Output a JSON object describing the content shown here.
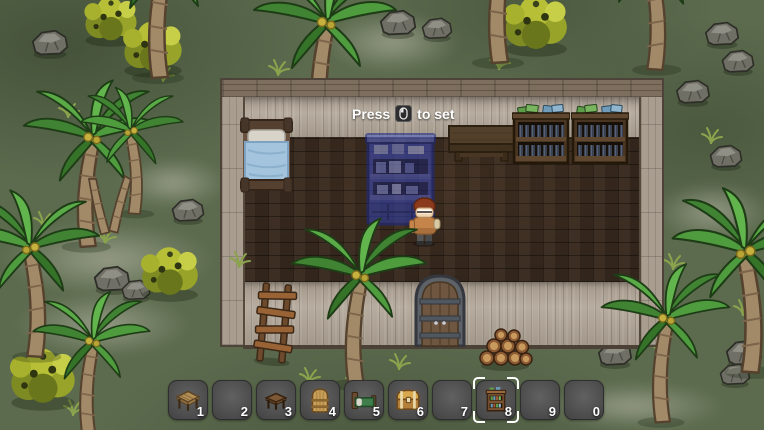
{
  "hint": {
    "prefix": "Press",
    "suffix": "to set",
    "icon": "mouse-left-button-icon"
  },
  "hotbar": {
    "selected_slot_key": "8",
    "slots": [
      {
        "key": "1",
        "item": "wooden-table"
      },
      {
        "key": "2",
        "item": ""
      },
      {
        "key": "3",
        "item": "small-dark-table"
      },
      {
        "key": "4",
        "item": "wooden-door"
      },
      {
        "key": "5",
        "item": "bed"
      },
      {
        "key": "6",
        "item": "treasure-chest"
      },
      {
        "key": "7",
        "item": ""
      },
      {
        "key": "8",
        "item": "bookshelf"
      },
      {
        "key": "9",
        "item": ""
      },
      {
        "key": "0",
        "item": ""
      }
    ]
  },
  "world": {
    "structure": "wooden-cabin",
    "furniture": [
      "bed",
      "bookshelf-ghost-preview",
      "wooden-table",
      "bookshelf-with-books",
      "bookshelf-with-books"
    ],
    "door": "arched-door",
    "player": "villager-character",
    "outdoor_objects": [
      "ladder",
      "log-pile",
      "palm-trees",
      "rocks",
      "bushes",
      "grass-tufts"
    ]
  },
  "colors": {
    "grass": "#5c6b4e",
    "floor": "#38291e",
    "wall": "#b3a89a",
    "slot_background": "#4e4e4e",
    "selection_bracket": "#ffffff",
    "hint_text": "#ffffff",
    "ghost_preview": "#3748b8"
  }
}
